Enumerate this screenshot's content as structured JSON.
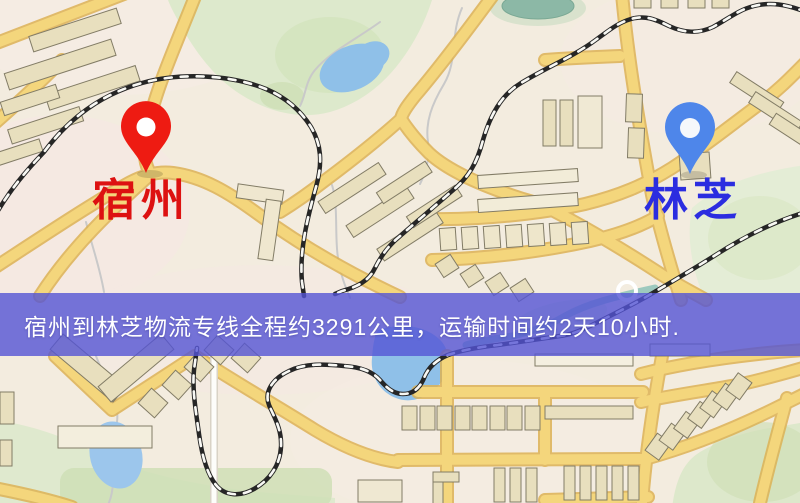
{
  "map": {
    "origin": {
      "name": "宿州"
    },
    "destination": {
      "name": "林芝"
    },
    "banner": {
      "text": "宿州到林芝物流专线全程约3291公里，运输时间约2天10小时."
    },
    "colors": {
      "origin_pin": "#ee1b12",
      "origin_label": "#dd1111",
      "destination_pin": "#4e86ea",
      "destination_label": "#2b2de0",
      "banner_background": "#5454d5",
      "banner_text": "#ffffff",
      "road_major": "#f4d67c",
      "road_casing": "#ddb255",
      "park_green": "#dde9cc",
      "water_blue": "#8fc0e8",
      "railway_black": "#262626",
      "building_tan": "#e8dfbe",
      "background_cream": "#f3ecdf"
    }
  }
}
